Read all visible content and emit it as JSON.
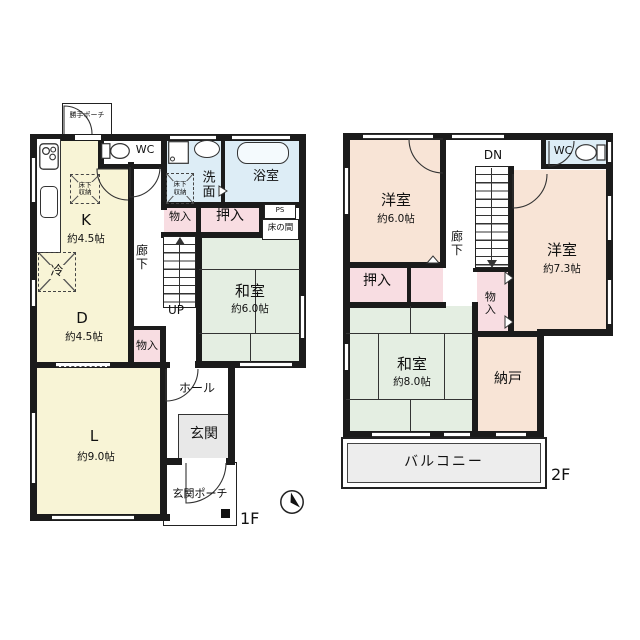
{
  "floor1": {
    "floor_label": "1F",
    "kitchen": {
      "name": "K",
      "size": "約4.5帖"
    },
    "dining": {
      "name": "D",
      "size": "約4.5帖"
    },
    "living": {
      "name": "L",
      "size": "約9.0帖"
    },
    "tatami_room": {
      "name": "和室",
      "size": "約6.0帖"
    },
    "toilet_label": "WC",
    "washroom_label": "洗面",
    "bathroom_label": "浴室",
    "corridor_label": "廊下",
    "hall_label": "ホール",
    "entrance_label": "玄関",
    "entrance_porch_label": "玄関ポーチ",
    "kitchen_porch_label": "勝手ポーチ",
    "closet_oshiire_label": "押入",
    "storage_corridor_label": "物入",
    "storage_dining_label": "物入",
    "tokonoma_label": "床の間",
    "pipe_space_label": "PS",
    "stairs_label": "UP",
    "fridge_label": "冷",
    "underfloor_storage_kitchen_label": "床下収納",
    "underfloor_storage_washroom_label": "床下収納"
  },
  "floor2": {
    "floor_label": "2F",
    "western_room_a": {
      "name": "洋室",
      "size": "約6.0帖"
    },
    "western_room_b": {
      "name": "洋室",
      "size": "約7.3帖"
    },
    "tatami_room": {
      "name": "和室",
      "size": "約8.0帖"
    },
    "storage_room_label": "納戸",
    "balcony_label": "バルコニー",
    "corridor_label": "廊下",
    "stairs_label": "DN",
    "closet_oshiire_label": "押入",
    "storage_label": "物入",
    "toilet_label": "WC"
  },
  "colors": {
    "wall": "#1b1b1b",
    "yellow_room": "#f8f4d6",
    "green_tatami": "#e4eee2",
    "pink_closet": "#f8dde2",
    "peach_room": "#f8e4d6",
    "blue_wet": "#ddedf6",
    "gray_entry": "#e8e8e8",
    "balcony": "#ededed"
  }
}
